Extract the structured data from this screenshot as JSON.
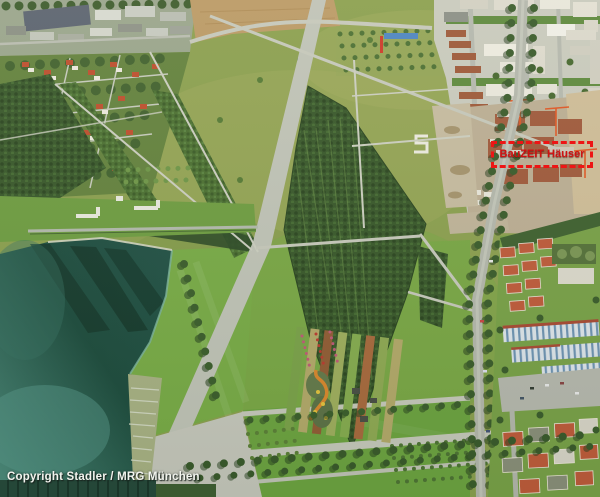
{
  "scene": {
    "type": "aerial-photograph",
    "regions": [
      "industrial-area-north",
      "suburb-west",
      "farm-field",
      "park-meadows",
      "forest-groves",
      "lake",
      "lakeside-terraces",
      "bathing-lawn",
      "esplanade",
      "gardens",
      "playground",
      "tree-boulevard",
      "urban-district-east",
      "construction-site"
    ]
  },
  "marker": {
    "label": "BauZEIT Häuser",
    "border_color": "#ed1515",
    "text_color": "#cf1111"
  },
  "copyright": {
    "text": "Copyright Stadler / MRG München",
    "text_color": "#f2f4ee"
  },
  "palette": {
    "lake_deep": "#1e4c3e",
    "lake_shallow": "#57988a",
    "meadow": "#8ca050",
    "lawn": "#74a845",
    "forest_dark": "#39582b",
    "forest_mid": "#4c7032",
    "path_gray": "#c6c8bb",
    "field_brown": "#bb9a66",
    "roof_red": "#bf5b3b",
    "construction_sand": "#cfbd98",
    "city_white": "#e9e7dc",
    "crane_orange": "#e05826"
  }
}
